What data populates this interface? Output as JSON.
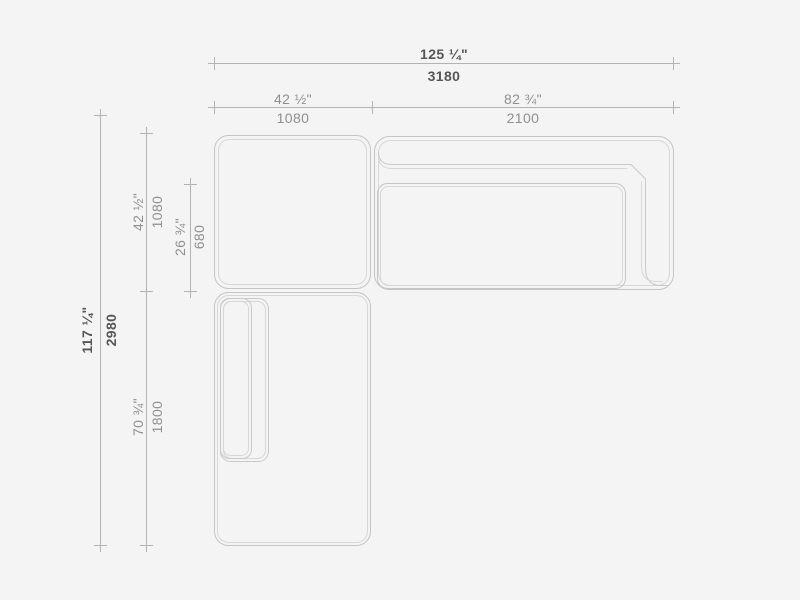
{
  "page": {
    "background": "#f4f4f4",
    "description": "Top-view technical dimension drawing of a modular sectional sofa with corner seat, two-seat sofa section and chaise section"
  },
  "drawing": {
    "line_colors": {
      "outline_outer": "#c5c5c5",
      "outline_inner": "#d7d7d7",
      "dimension_line": "#b3b3b3"
    },
    "modules": [
      {
        "name": "corner seat module"
      },
      {
        "name": "sofa module with backrest and right armrest"
      },
      {
        "name": "chaise module with left armrest"
      }
    ]
  },
  "dimensions": {
    "width_total": {
      "inches": "125 ¼\"",
      "mm": "3180"
    },
    "width_left": {
      "inches": "42 ½\"",
      "mm": "1080"
    },
    "width_right": {
      "inches": "82 ¾\"",
      "mm": "2100"
    },
    "height_total": {
      "inches": "117 ¼\"",
      "mm": "2980"
    },
    "height_corner": {
      "inches": "42 ½\"",
      "mm": "1080"
    },
    "depth_seat": {
      "inches": "26 ¾\"",
      "mm": "680"
    },
    "height_chaise": {
      "inches": "70 ¾\"",
      "mm": "1800"
    }
  }
}
